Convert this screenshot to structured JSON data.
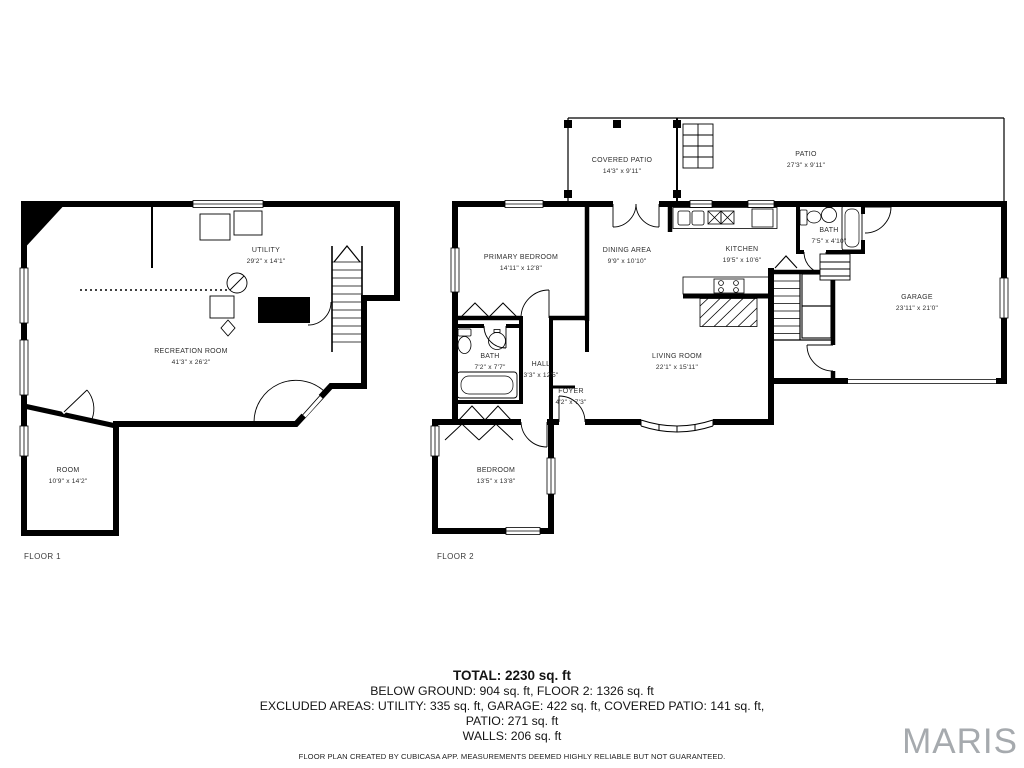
{
  "page": {
    "background": "#ffffff",
    "wall_color": "#000000",
    "label_color": "#2e2e2e",
    "watermark_color": "#a6aaae"
  },
  "floor1": {
    "caption": "FLOOR 1",
    "rooms": [
      {
        "name": "UTILITY",
        "dims": "29'2\" x 14'1\""
      },
      {
        "name": "RECREATION ROOM",
        "dims": "41'3\" x 26'2\""
      },
      {
        "name": "ROOM",
        "dims": "10'9\" x 14'2\""
      }
    ]
  },
  "floor2": {
    "caption": "FLOOR 2",
    "rooms": [
      {
        "name": "COVERED PATIO",
        "dims": "14'3\" x 9'11\""
      },
      {
        "name": "PATIO",
        "dims": "27'3\" x 9'11\""
      },
      {
        "name": "PRIMARY BEDROOM",
        "dims": "14'11\" x 12'8\""
      },
      {
        "name": "DINING AREA",
        "dims": "9'9\" x 10'10\""
      },
      {
        "name": "KITCHEN",
        "dims": "19'5\" x 10'6\""
      },
      {
        "name": "BATH",
        "dims": "7'5\" x 4'10\""
      },
      {
        "name": "GARAGE",
        "dims": "23'11\" x 21'0\""
      },
      {
        "name": "BATH",
        "dims": "7'2\" x 7'7\""
      },
      {
        "name": "HALL",
        "dims": "3'3\" x 12'5\""
      },
      {
        "name": "FOYER",
        "dims": "4'2\" x 7'3\""
      },
      {
        "name": "LIVING ROOM",
        "dims": "22'1\" x 15'11\""
      },
      {
        "name": "BEDROOM",
        "dims": "13'5\" x 13'8\""
      }
    ]
  },
  "summary": {
    "total": "TOTAL: 2230 sq. ft",
    "line2": "BELOW GROUND: 904 sq. ft, FLOOR 2: 1326 sq. ft",
    "line3": "EXCLUDED AREAS: UTILITY: 335 sq. ft, GARAGE: 422 sq. ft, COVERED PATIO: 141 sq. ft,",
    "line4": "PATIO: 271 sq. ft",
    "line5": "WALLS: 206 sq. ft",
    "disclaimer": "FLOOR PLAN CREATED BY CUBICASA APP. MEASUREMENTS DEEMED HIGHLY RELIABLE BUT NOT GUARANTEED."
  },
  "watermark": "MARIS"
}
